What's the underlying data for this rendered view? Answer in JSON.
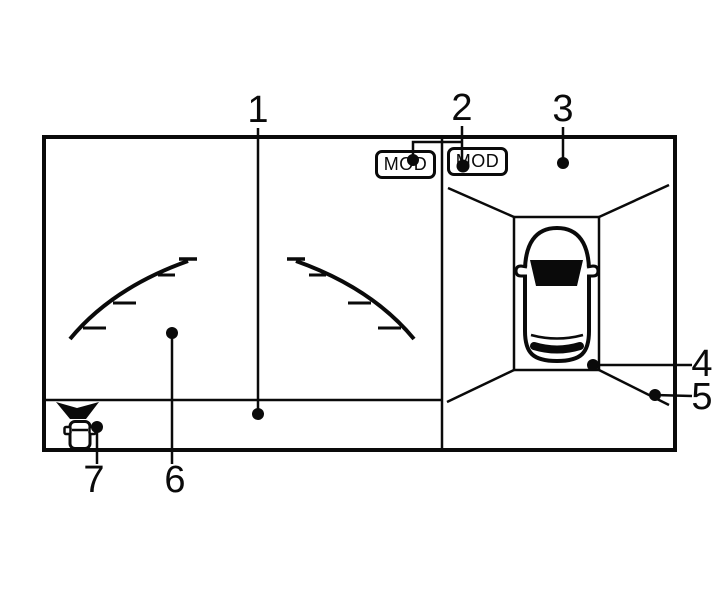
{
  "figure": {
    "colors": {
      "background": "#ffffff",
      "ink": "#0a0a0a"
    },
    "screen": {
      "mod_badges": [
        {
          "label": "MOD"
        },
        {
          "label": "MOD"
        }
      ],
      "icons": {
        "vehicle_top_view": "car-top-view-icon",
        "sonar_indicator": "sonar-beam-car-icon",
        "left_guideline": "rear-distance-guideline-left",
        "right_guideline": "rear-distance-guideline-right",
        "birdseye_parking_box": "parking-space-box"
      }
    },
    "callouts": [
      {
        "number": "1"
      },
      {
        "number": "2"
      },
      {
        "number": "3"
      },
      {
        "number": "4"
      },
      {
        "number": "5"
      },
      {
        "number": "6"
      },
      {
        "number": "7"
      }
    ]
  }
}
